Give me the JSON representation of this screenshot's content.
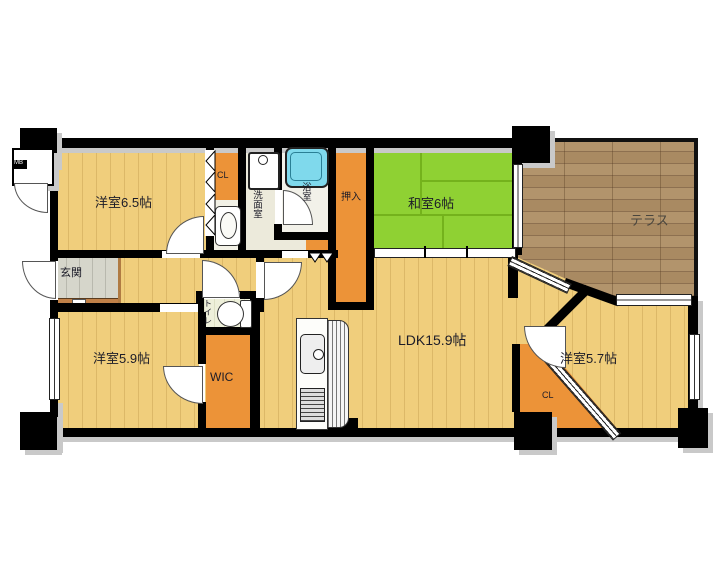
{
  "labels": {
    "yoshitsu65": "洋室6.5帖",
    "washitsu": "和室6帖",
    "terrace": "テラス",
    "ldk": "LDK15.9帖",
    "yoshitsu59": "洋室5.9帖",
    "yoshitsu57": "洋室5.7帖",
    "wic": "WIC",
    "genkan": "玄関",
    "oshiire": "押入",
    "senmenshitsu": "洗面室",
    "yokushitsu": "浴室",
    "toilet": "トイレ",
    "cl_north": "CL",
    "cl_south": "CL",
    "mb": "MB"
  },
  "colors": {
    "wall": "#000000",
    "wood_floor": "#f0ce7c",
    "tatami_green": "#8fd133",
    "closet_orange": "#ec9338",
    "terrace_wood": "#b2946c",
    "bathtub_blue": "#7fd9ec",
    "entrance_tile": "#d6d6cb",
    "entrance_step": "#c08048"
  }
}
